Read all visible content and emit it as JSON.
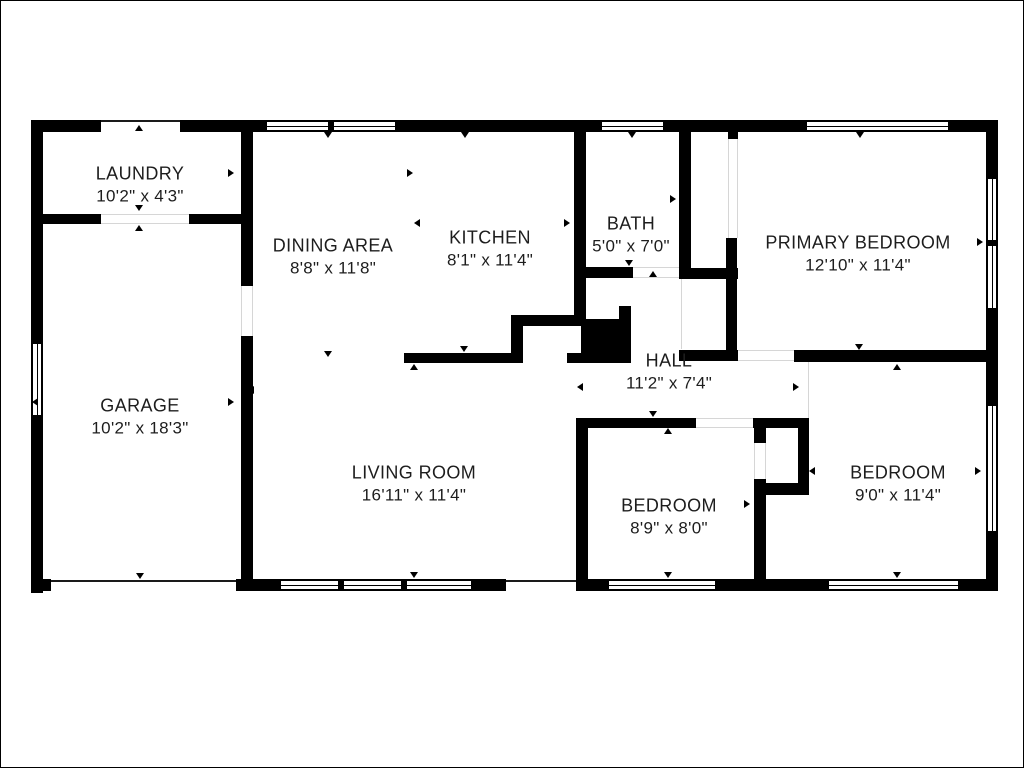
{
  "colors": {
    "background": "#ffffff",
    "wall": "#000000",
    "text": "#1d1d1d",
    "opening_line": "#d6d6d6"
  },
  "rooms": [
    {
      "id": "laundry",
      "name": "LAUNDRY",
      "size": "10'2\" x 4'3\""
    },
    {
      "id": "dining",
      "name": "DINING AREA",
      "size": "8'8\" x 11'8\""
    },
    {
      "id": "kitchen",
      "name": "KITCHEN",
      "size": "8'1\" x 11'4\""
    },
    {
      "id": "bath",
      "name": "BATH",
      "size": "5'0\" x 7'0\""
    },
    {
      "id": "primary",
      "name": "PRIMARY BEDROOM",
      "size": "12'10\" x 11'4\""
    },
    {
      "id": "garage",
      "name": "GARAGE",
      "size": "10'2\" x 18'3\""
    },
    {
      "id": "hall",
      "name": "HALL",
      "size": "11'2\" x 7'4\""
    },
    {
      "id": "living",
      "name": "LIVING ROOM",
      "size": "16'11\" x 11'4\""
    },
    {
      "id": "bedroom2",
      "name": "BEDROOM",
      "size": "8'9\" x 8'0\""
    },
    {
      "id": "bedroom3",
      "name": "BEDROOM",
      "size": "9'0\" x 11'4\""
    }
  ]
}
